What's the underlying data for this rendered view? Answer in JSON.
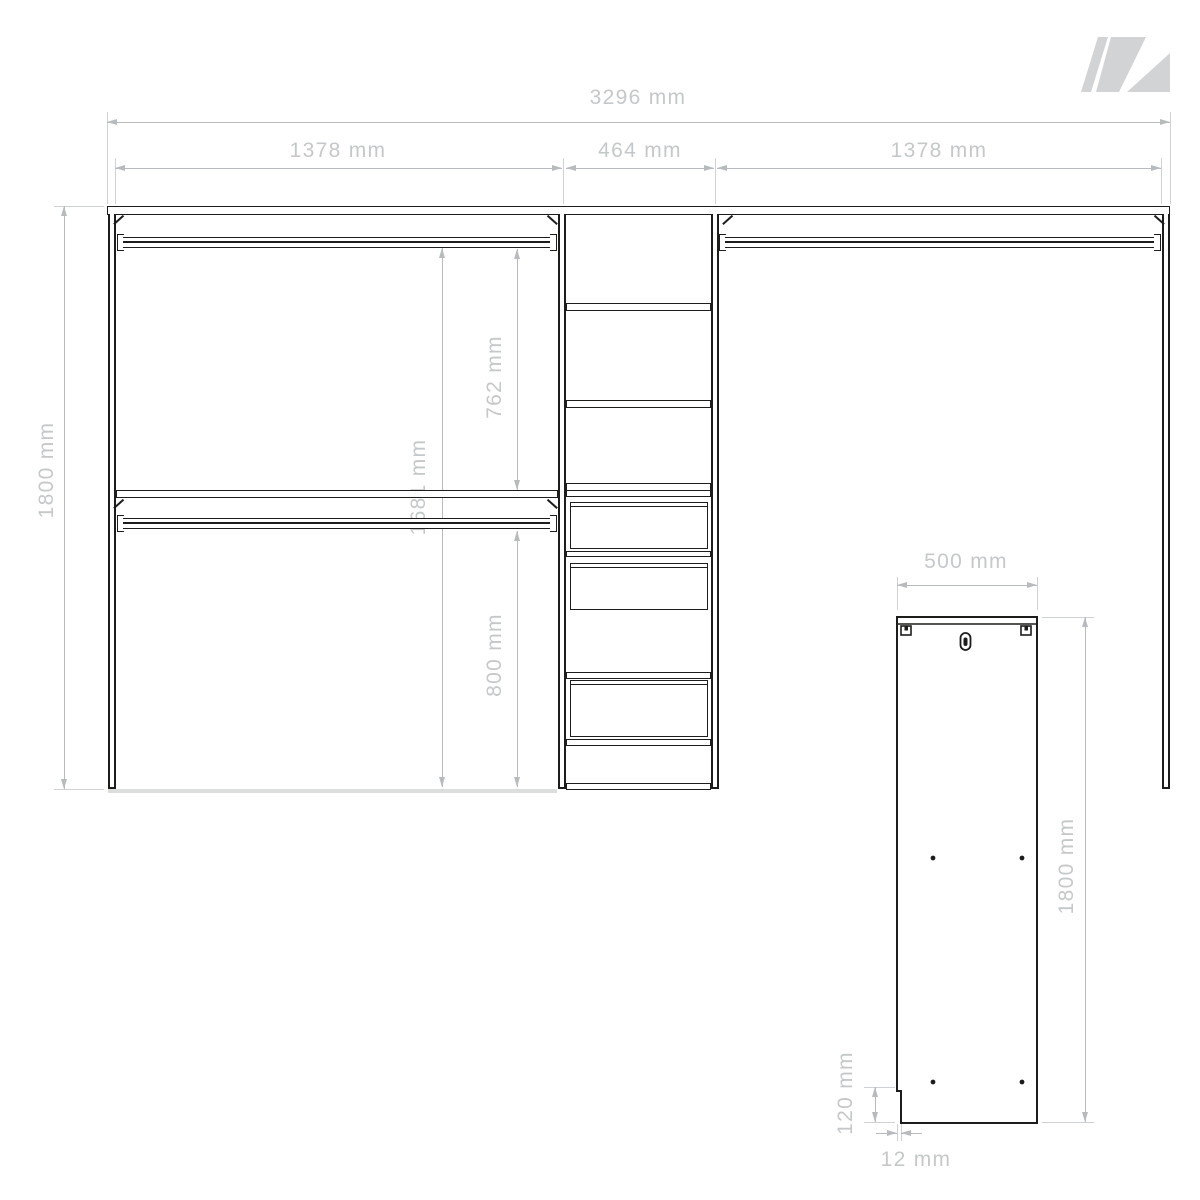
{
  "drawing_type": "wardrobe interior front elevation with side panel detail",
  "colors": {
    "ink": "#1d1d1b",
    "dimension_line": "#b7bbbe",
    "dimension_text": "#c5c8ca",
    "logo": "#d2d3d5",
    "background": "#ffffff"
  },
  "logo": {
    "name": "brand-mark",
    "color": "#d2d3d5"
  },
  "dims": {
    "total_width": "3296 mm",
    "left_width": "1378 mm",
    "center_width": "464 mm",
    "right_width": "1378 mm",
    "total_height": "1800 mm",
    "interior_height": "1681 mm",
    "upper_compartment": "762 mm",
    "lower_compartment": "800 mm"
  },
  "panel": {
    "width": "500 mm",
    "height": "1800 mm",
    "notch_height": "120 mm",
    "thickness": "12 mm"
  }
}
